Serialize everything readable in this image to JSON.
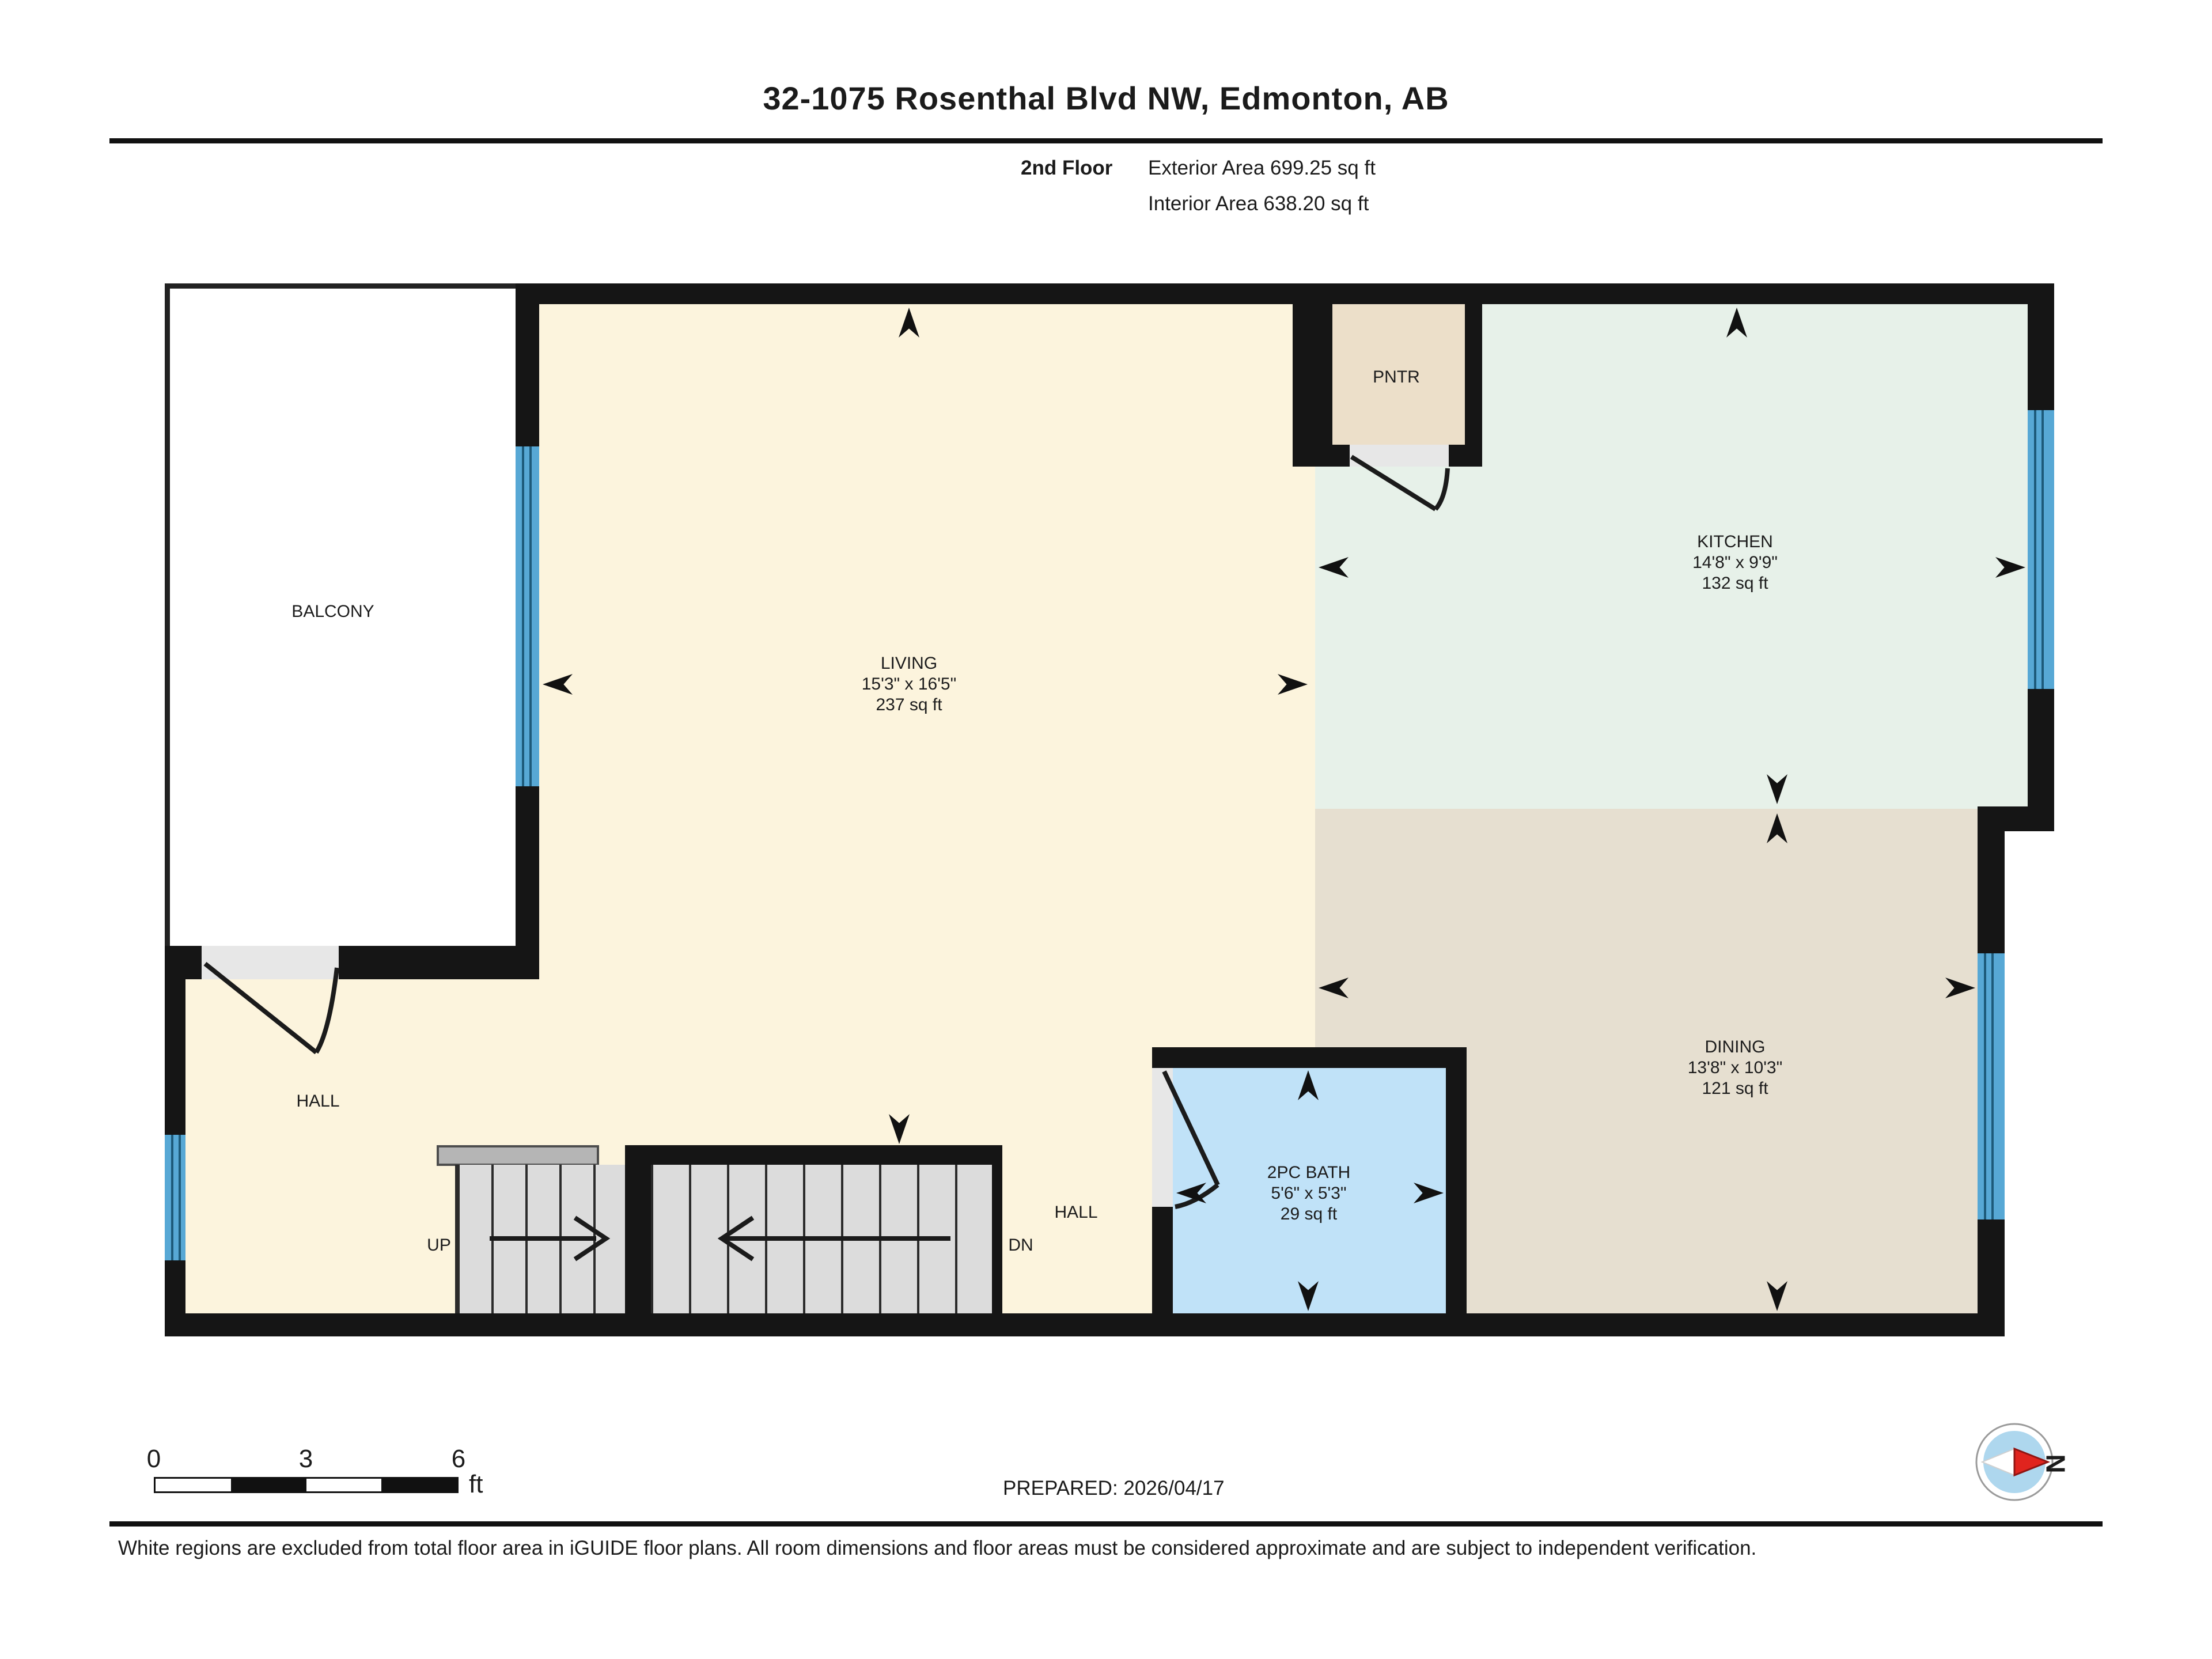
{
  "header": {
    "title": "32-1075 Rosenthal Blvd NW, Edmonton, AB",
    "floor_label": "2nd Floor",
    "exterior_area": "Exterior Area 699.25 sq ft",
    "interior_area": "Interior Area 638.20 sq ft"
  },
  "rooms": {
    "balcony": {
      "name": "BALCONY"
    },
    "living": {
      "name": "LIVING",
      "dims": "15'3\" x 16'5\"",
      "area": "237 sq ft"
    },
    "kitchen": {
      "name": "KITCHEN",
      "dims": "14'8\" x 9'9\"",
      "area": "132 sq ft"
    },
    "pantry": {
      "name": "PNTR"
    },
    "dining": {
      "name": "DINING",
      "dims": "13'8\" x 10'3\"",
      "area": "121 sq ft"
    },
    "bath": {
      "name": "2PC BATH",
      "dims": "5'6\" x 5'3\"",
      "area": "29 sq ft"
    },
    "hall_left": {
      "name": "HALL"
    },
    "hall_right": {
      "name": "HALL"
    }
  },
  "stairs": {
    "up": "UP",
    "down": "DN"
  },
  "footer": {
    "prepared": "PREPARED: 2026/04/17",
    "disclaimer": "White regions are excluded from total floor area in iGUIDE floor plans. All room dimensions and floor areas must be considered approximate and are subject to independent verification.",
    "scale_ticks": {
      "t0": "0",
      "t3": "3",
      "t6": "6"
    },
    "scale_unit": "ft",
    "compass_north": "N"
  },
  "colors": {
    "wall": "#151515",
    "living_fill": "#fcf4dd",
    "kitchen_fill": "#e7f1e9",
    "dining_fill": "#e6dfd0",
    "pantry_fill": "#ecdfc9",
    "bath_fill": "#c0e2f8",
    "window_blue": "#57a8d5",
    "compass_red": "#e0241e"
  }
}
